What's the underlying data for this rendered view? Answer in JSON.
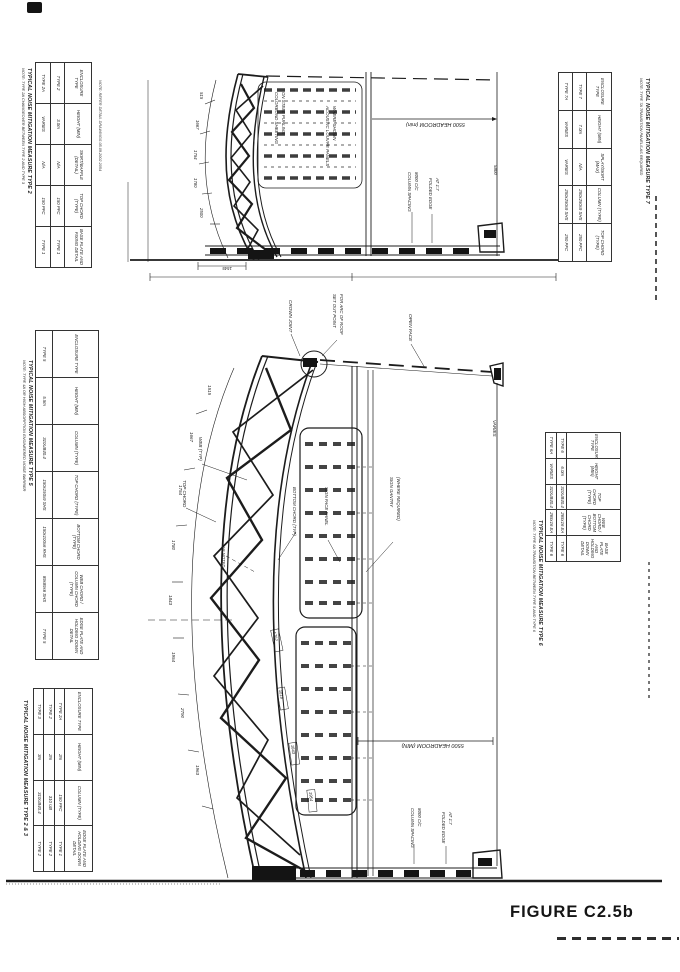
{
  "figure_label": "FIGURE C2.5b",
  "tables": {
    "top_left": {
      "title": "TYPICAL NOISE MITIGATION MEASURE TYPE 2",
      "note": "NOTE: TYPE 2A CHANGEOVER BETWEEN TYPE 2 AND TYPE 3",
      "side_note": "NOTE: REFER DETAIL DRAWINGS 05.09.2002 2054",
      "headers": [
        "ENCLOSURE TYPE",
        "HEIGHT (MIN)",
        "SKIRT/BAFFLE (DETAIL)",
        "TOP CHORD (TYPE)",
        "BASE PLATE AND FIXING DETAIL"
      ],
      "rows": [
        [
          "TYPE 2",
          "3.0m",
          "N/A",
          "150 PFC",
          "TYPE 1"
        ],
        [
          "TYPE 2A",
          "VARIES",
          "N/A",
          "150 PFC",
          "TYPE 1"
        ]
      ]
    },
    "top_right": {
      "title": "TYPICAL NOISE MITIGATION MEASURE TYPE 7",
      "note": "NOTE: TYPE 7A TRANSITION PANELS AS REQUIRED",
      "headers": [
        "ENCLOSURE TYPE",
        "HEIGHT (MIN)",
        "SPLAY/SKIRT (MAX)",
        "COLUMN (TYPE)",
        "TOP CHORD (TYPE)"
      ],
      "rows": [
        [
          "TYPE 7",
          "7.0m",
          "N/A",
          "250x250x9 SHS",
          "250 PFC"
        ],
        [
          "TYPE 7A",
          "VARIES",
          "VARIES",
          "250x250x9 SHS",
          "250 PFC"
        ]
      ]
    },
    "left_middle": {
      "title": "TYPICAL NOISE MITIGATION MEASURE TYPE 5",
      "note": "NOTE: TYPE 4A OR HIGH ABSORPTION ENGINEERED NOISE BARRIER",
      "headers": [
        "ENCLOSURE TYPE",
        "HEIGHT (MIN)",
        "COLUMN (TYPE)",
        "TOP CHORD (TYPE)",
        "BOTTOM CHORD (TYPE)",
        "WEB CHORD / COLUMN CHORD (TYPE)",
        "EDGE PLATE AND HOLDING DOWN DETAIL"
      ],
      "rows": [
        [
          "TYPE 5",
          "5.5m",
          "310UB40.4",
          "150x150x9 SHS",
          "150x100x6 RHS",
          "89x89x6 SHS",
          "TYPE 5"
        ]
      ]
    },
    "right_middle": {
      "title": "TYPICAL NOISE MITIGATION MEASURE TYPE 6",
      "note": "NOTE: TYPE 6A TRANSITION BETWEEN TYPE 5 AND TYPE 6",
      "headers": [
        "ENCLOSURE TYPE",
        "HEIGHT (MIN)",
        "TOP CHORD (TYPE)",
        "WEB CHORD / BOTTOM CHORD (TYPE)",
        "BASE PLATE AND HOLDING DOWN DETAIL"
      ],
      "rows": [
        [
          "TYPE 6",
          "6.0m",
          "310UB40.4",
          "265x16 EA",
          "TYPE 6"
        ],
        [
          "TYPE 6A",
          "VARIES",
          "310UB40.4",
          "265x16 EA",
          "TYPE 6"
        ]
      ]
    },
    "bottom_left": {
      "title": "TYPICAL NOISE MITIGATION MEASURE TYPE 2 & 3",
      "headers": [
        "ENCLOSURE TYPE",
        "HEIGHT (MIN)",
        "COLUMN (TYPE)",
        "EDGE PLATE AND HOLDING DOWN DETAIL"
      ],
      "rows": [
        [
          "TYPE 2A",
          "2m",
          "150 PFC",
          "TYPE 1"
        ],
        [
          "TYPE 2",
          "2m",
          "310 UB",
          "TYPE 2"
        ],
        [
          "TYPE 3",
          "3m",
          "310UB40.4",
          "TYPE 2"
        ]
      ]
    }
  },
  "top_drawing": {
    "labels": {
      "sheeting1": "COLORBOND SHEETING",
      "sheeting2": "ON STEEL PURLINS",
      "louvre1": "ACOUSTIC LOUVRE PANELS",
      "louvre2": "WHERE SHOWN",
      "headroom": "5500 HEADROOM (min)",
      "column_spacing1": "COLUMN SPACING",
      "column_spacing2": "8000 C/C",
      "folded_edge1": "FOLDED EDGE",
      "folded_edge2": "AT 1:7",
      "height_right": "5800"
    },
    "dims": {
      "d1": "515",
      "d2": "1667",
      "d3": "1754",
      "d4": "1780",
      "d5": "2500",
      "base": "1545"
    }
  },
  "main_drawing": {
    "labels": {
      "crown": "CROWN JOINT",
      "setout1": "SET OUT POINT",
      "setout2": "FOR ARC OF ROOF",
      "open_face": "OPEN FACE",
      "top_chord": "TOP CHORD",
      "web": "WEB (TYP)",
      "bottom_chord": "BOTTOM CHORD (TYP)",
      "sign_face": "SIGN FACE PANEL",
      "sign_gantry1": "SIGN GANTRY",
      "sign_gantry2": "(WHERE REQUIRED)",
      "as_noted": "AS NOTED",
      "headroom": "5500 HEADROOM (MIN)",
      "column_spacing1": "COLUMN SPACING",
      "column_spacing2": "8000 C/C",
      "folded_edge1": "FOLDED EDGE",
      "folded_edge2": "AT 1:7",
      "varies": "VARIES"
    },
    "dims": {
      "d1": "1515",
      "d2": "1667",
      "d3": "1754",
      "d4": "1780",
      "d5": "1843",
      "d6": "1954",
      "d7": "2790",
      "d8": "1963",
      "c1": "1762",
      "c2": "1818",
      "c3": "1843",
      "c4": "1954"
    }
  }
}
